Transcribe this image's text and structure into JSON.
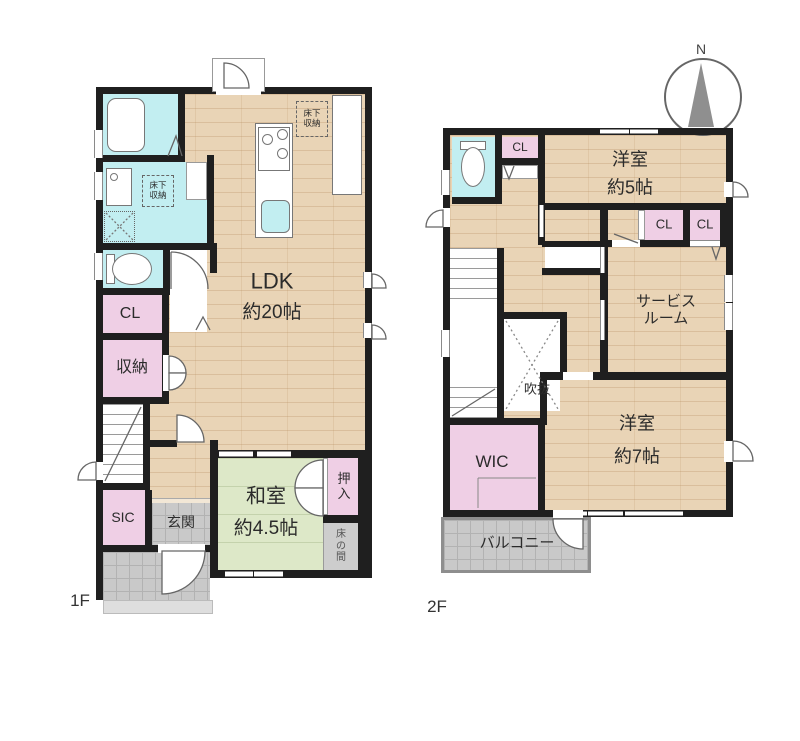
{
  "floor1": {
    "label": "1F",
    "ldk": {
      "name": "LDK",
      "size": "約20帖"
    },
    "underfloor_storage_wash": "床下収納",
    "underfloor_storage_kitchen": "床下収納",
    "closet": "CL",
    "storage": "収納",
    "sic": "SIC",
    "genkan": "玄関",
    "washitsu": {
      "name": "和室",
      "size": "約4.5帖"
    },
    "oshiire": "押入",
    "tokonoma": "床の間"
  },
  "floor2": {
    "label": "2F",
    "closet_hall": "CL",
    "bedroom5": {
      "name": "洋室",
      "size": "約5帖"
    },
    "closet_a": "CL",
    "closet_b": "CL",
    "service_room": "サービスルーム",
    "void": "吹抜",
    "wic": "WIC",
    "bedroom7": {
      "name": "洋室",
      "size": "約7帖"
    },
    "balcony": "バルコニー"
  },
  "compass": {
    "north": "N"
  },
  "colors": {
    "wall": "#1f1f1f",
    "wood": "#e9d4b6",
    "wet": "#c2eef1",
    "closet": "#efcfe5",
    "tatami": "#dde8c8",
    "tile": "#c9c9c9",
    "step": "#dedede",
    "label": "#2b2b2b",
    "fix": "#777777",
    "compass": "#8f8f8f"
  }
}
